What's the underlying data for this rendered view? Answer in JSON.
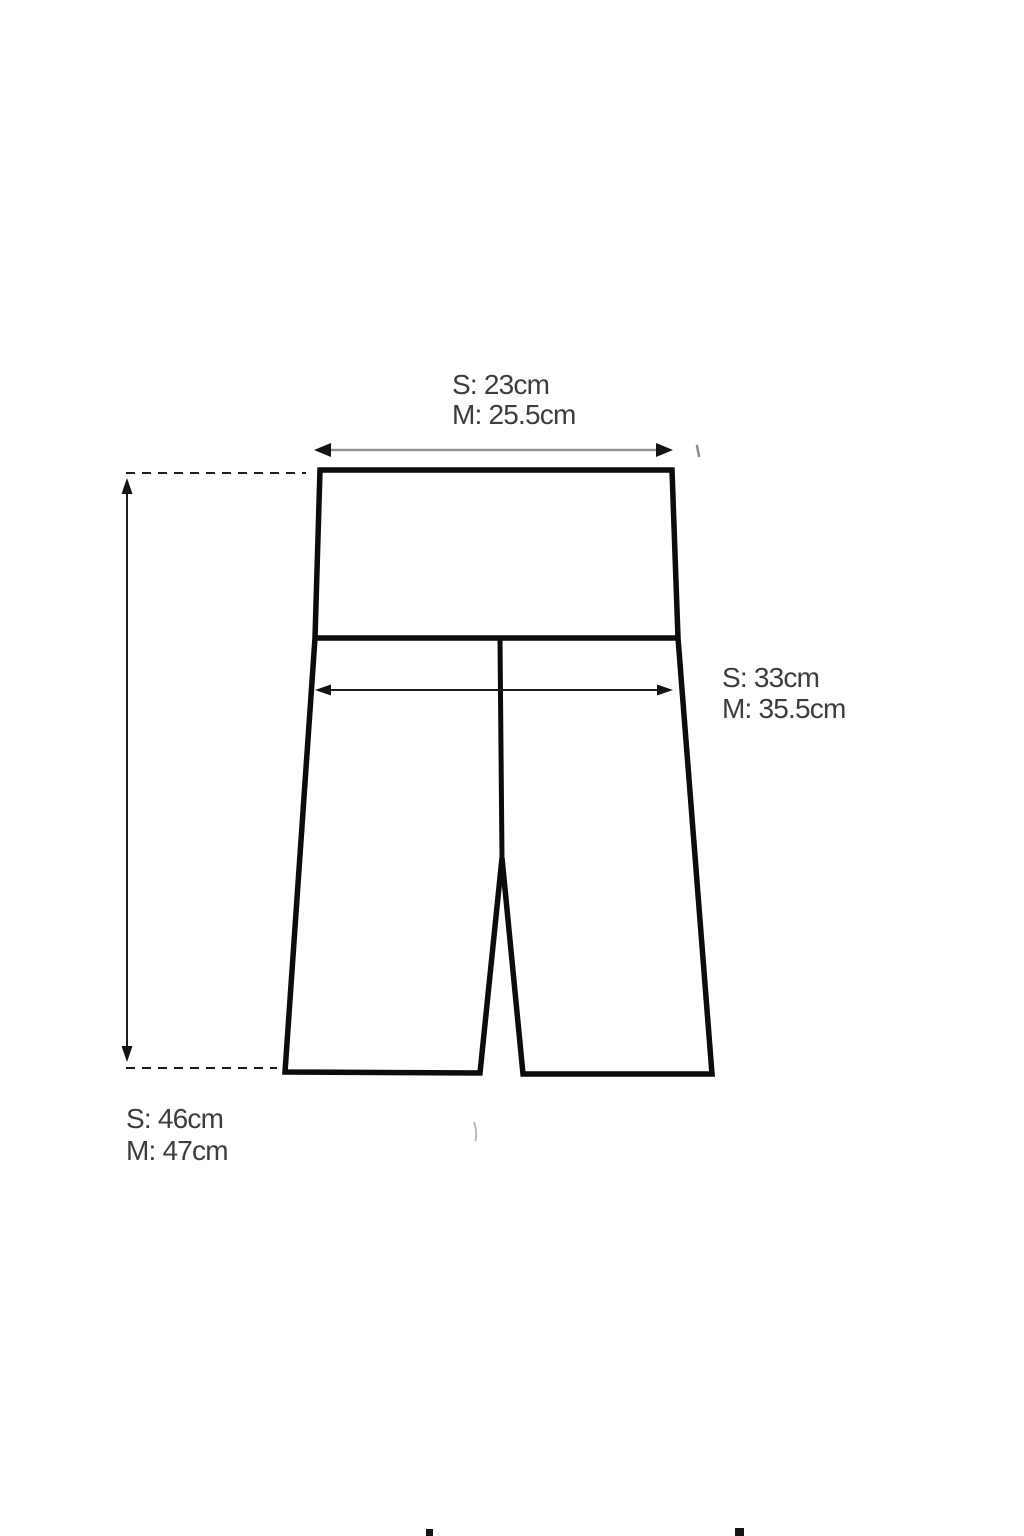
{
  "colors": {
    "outline": "#0c0c0c",
    "seam": "#0c0c0c",
    "label": "#3d3d3f",
    "dimension_line": "#1c1c1c",
    "waist_arrow_shaft": "#929292",
    "arrowhead": "#131313",
    "stray_tick": "#8a8a8a",
    "faint_mark": "#ababab",
    "background": "#ffffff"
  },
  "labels": {
    "waist_width": {
      "s": "S: 23cm",
      "m": "M: 25.5cm"
    },
    "hip_width": {
      "s": "S: 33cm",
      "m": "M: 35.5cm"
    },
    "length": {
      "s": "S: 46cm",
      "m": "M: 47cm"
    }
  }
}
